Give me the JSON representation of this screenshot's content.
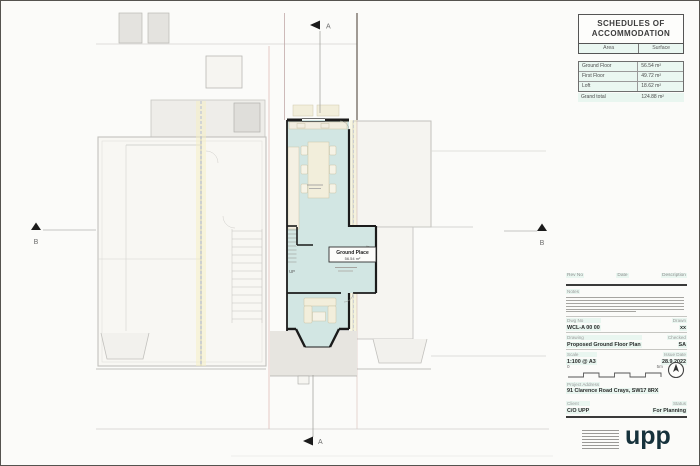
{
  "plan": {
    "section_marker_a": "A",
    "section_marker_b": "B",
    "room_label": {
      "name": "Ground Place",
      "area": "56.54 m²"
    },
    "stairs_label": "UP"
  },
  "schedules": {
    "title": "SCHEDULES OF ACCOMMODATION",
    "col_area": "Area",
    "col_surface": "Surface",
    "rows": [
      {
        "area": "Ground Floor",
        "surface": "56.54 m²"
      },
      {
        "area": "First Floor",
        "surface": "49.72 m²"
      },
      {
        "area": "Loft",
        "surface": "18.62 m²"
      }
    ],
    "total_label": "Grand total",
    "total_value": "124.88 m²"
  },
  "revision_table": {
    "col_rev_no": "Rev No",
    "col_date": "Date",
    "col_description": "Description"
  },
  "notes": {
    "label": "Notes"
  },
  "title_block": {
    "dwg_no_label": "Dwg No",
    "dwg_no": "WCL-A 00 00",
    "drawn_label": "Drawn",
    "drawn": "xx",
    "drawing_label": "Drawing",
    "drawing": "Proposed Ground Floor Plan",
    "checked_label": "Checked",
    "checked": "SA",
    "scale_label": "Scale",
    "scale": "1:100 @ A3",
    "issue_date_label": "Issue Date",
    "issue_date": "28.9.2022",
    "scalebar": {
      "start": "0",
      "end": "5m"
    },
    "project_address_label": "Project Address",
    "project_address": "91 Clarence Road Crays, SW17 8RX",
    "client_label": "Client",
    "client": "C/O UPP",
    "status_label": "Status",
    "status": "For Planning"
  },
  "branding": {
    "logo_text": "upp",
    "logo_color": "#16323c"
  },
  "colors": {
    "unit_fill": "#d2e6e3",
    "wall": "#1b1b1b",
    "context_line": "#c2c1bd",
    "party_wall_highlight": "#f6f0c2",
    "highlight_mint": "#e8f5ee"
  }
}
